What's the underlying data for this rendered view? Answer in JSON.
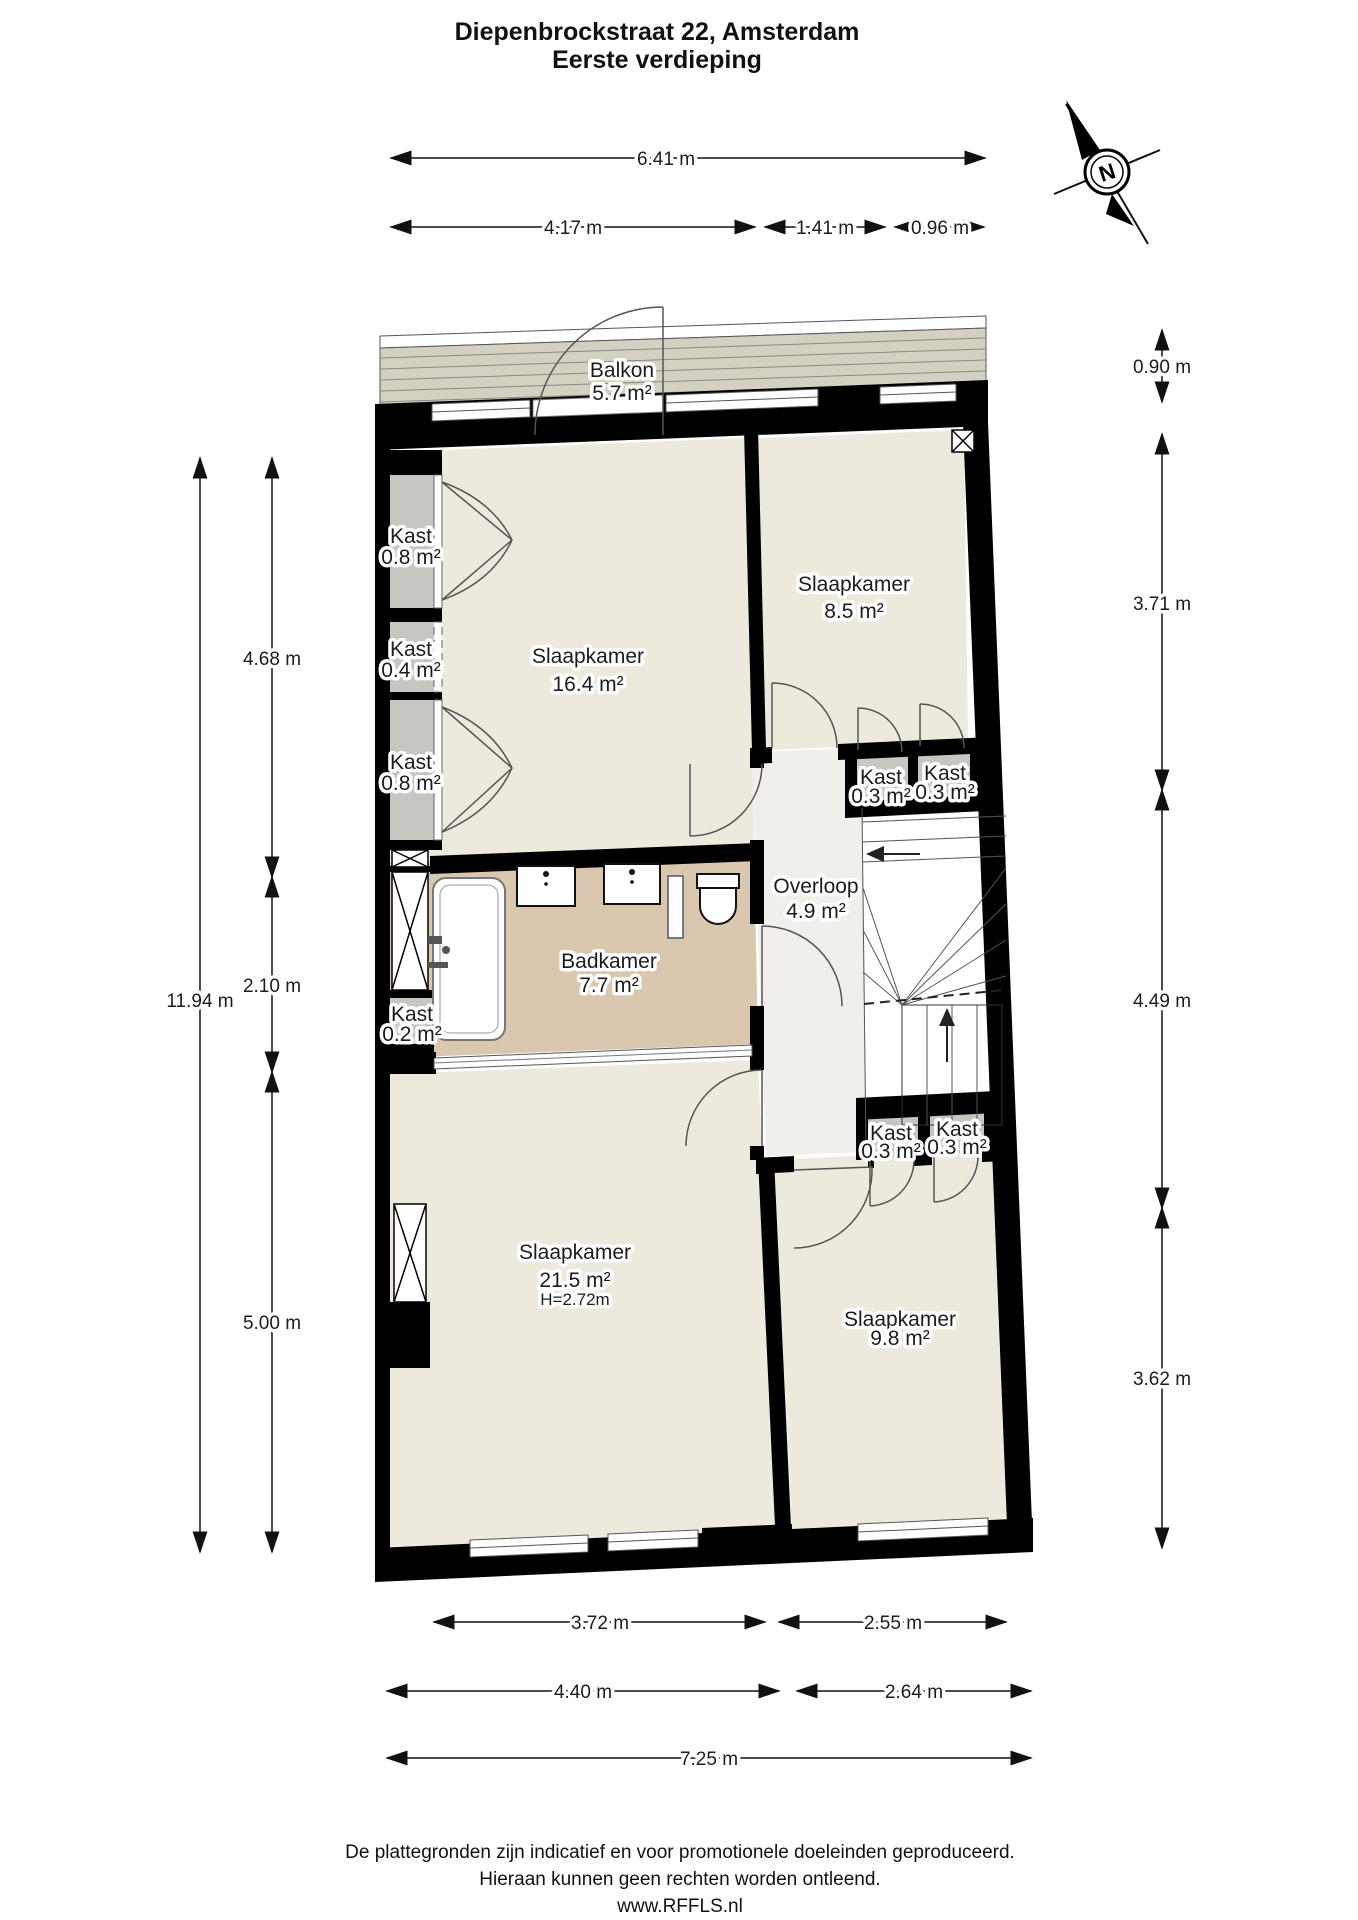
{
  "title": {
    "line1": "Diepenbrockstraat 22, Amsterdam",
    "line2": "Eerste verdieping"
  },
  "compass": {
    "north_label": "N"
  },
  "rooms": {
    "balkon": {
      "name": "Balkon",
      "area": "5.7 m²"
    },
    "kast_a": {
      "name": "Kast",
      "area": "0.8 m²"
    },
    "kast_b": {
      "name": "Kast",
      "area": "0.4 m²"
    },
    "kast_c": {
      "name": "Kast",
      "area": "0.8 m²"
    },
    "slaapkamer1": {
      "name": "Slaapkamer",
      "area": "16.4 m²"
    },
    "slaapkamer2": {
      "name": "Slaapkamer",
      "area": "8.5 m²"
    },
    "kast_d": {
      "name": "Kast",
      "area": "0.3 m²"
    },
    "kast_e": {
      "name": "Kast",
      "area": "0.3 m²"
    },
    "overloop": {
      "name": "Overloop",
      "area": "4.9 m²"
    },
    "badkamer": {
      "name": "Badkamer",
      "area": "7.7 m²"
    },
    "kast_f": {
      "name": "Kast",
      "area": "0.2 m²"
    },
    "slaapkamer3": {
      "name": "Slaapkamer",
      "area": "21.5 m²",
      "height": "H=2.72m"
    },
    "kast_g": {
      "name": "Kast",
      "area": "0.3 m²"
    },
    "kast_h": {
      "name": "Kast",
      "area": "0.3 m²"
    },
    "slaapkamer4": {
      "name": "Slaapkamer",
      "area": "9.8 m²"
    }
  },
  "dimensions": {
    "top_total": "6.41 m",
    "top1": "4.17 m",
    "top2": "1.41 m",
    "top3": "0.96 m",
    "left_total": "11.94 m",
    "left1": "4.68 m",
    "left2": "2.10 m",
    "left3": "5.00 m",
    "right1": "0.90 m",
    "right2": "3.71 m",
    "right3": "4.49 m",
    "right4": "3.62 m",
    "bottom1": "3.72 m",
    "bottom2": "2.55 m",
    "bottom3": "4.40 m",
    "bottom4": "2.64 m",
    "bottom_total": "7.25 m"
  },
  "footer": {
    "line1": "De plattegronden zijn indicatief en voor promotionele doeleinden geproduceerd.",
    "line2": "Hieraan kunnen geen rechten worden ontleend.",
    "line3": "www.RFFLS.nl"
  },
  "colors": {
    "wall": "#000000",
    "room_floor": "#ede9dd",
    "kast_floor": "#c4c8c0",
    "badkamer_floor": "#d9c7b0",
    "overloop_floor": "#f0efe9",
    "balkon_floor": "#d4d1c3",
    "line": "#4a4a4a"
  }
}
